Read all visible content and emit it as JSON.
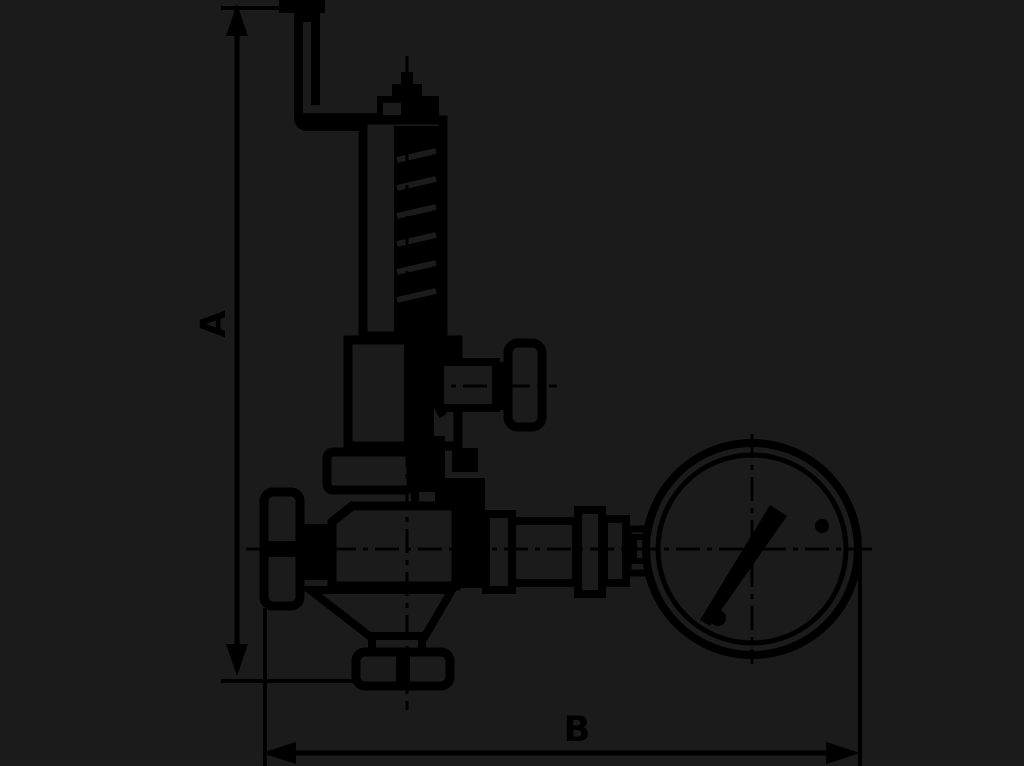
{
  "diagram": {
    "type": "technical-line-drawing",
    "subject": "safety-relief-valve-with-pressure-gauge",
    "colors": {
      "background": "#1b1b1b",
      "ink": "#000000"
    },
    "dimension_a": {
      "label": "A",
      "orientation": "vertical"
    },
    "dimension_b": {
      "label": "B",
      "orientation": "horizontal"
    }
  }
}
